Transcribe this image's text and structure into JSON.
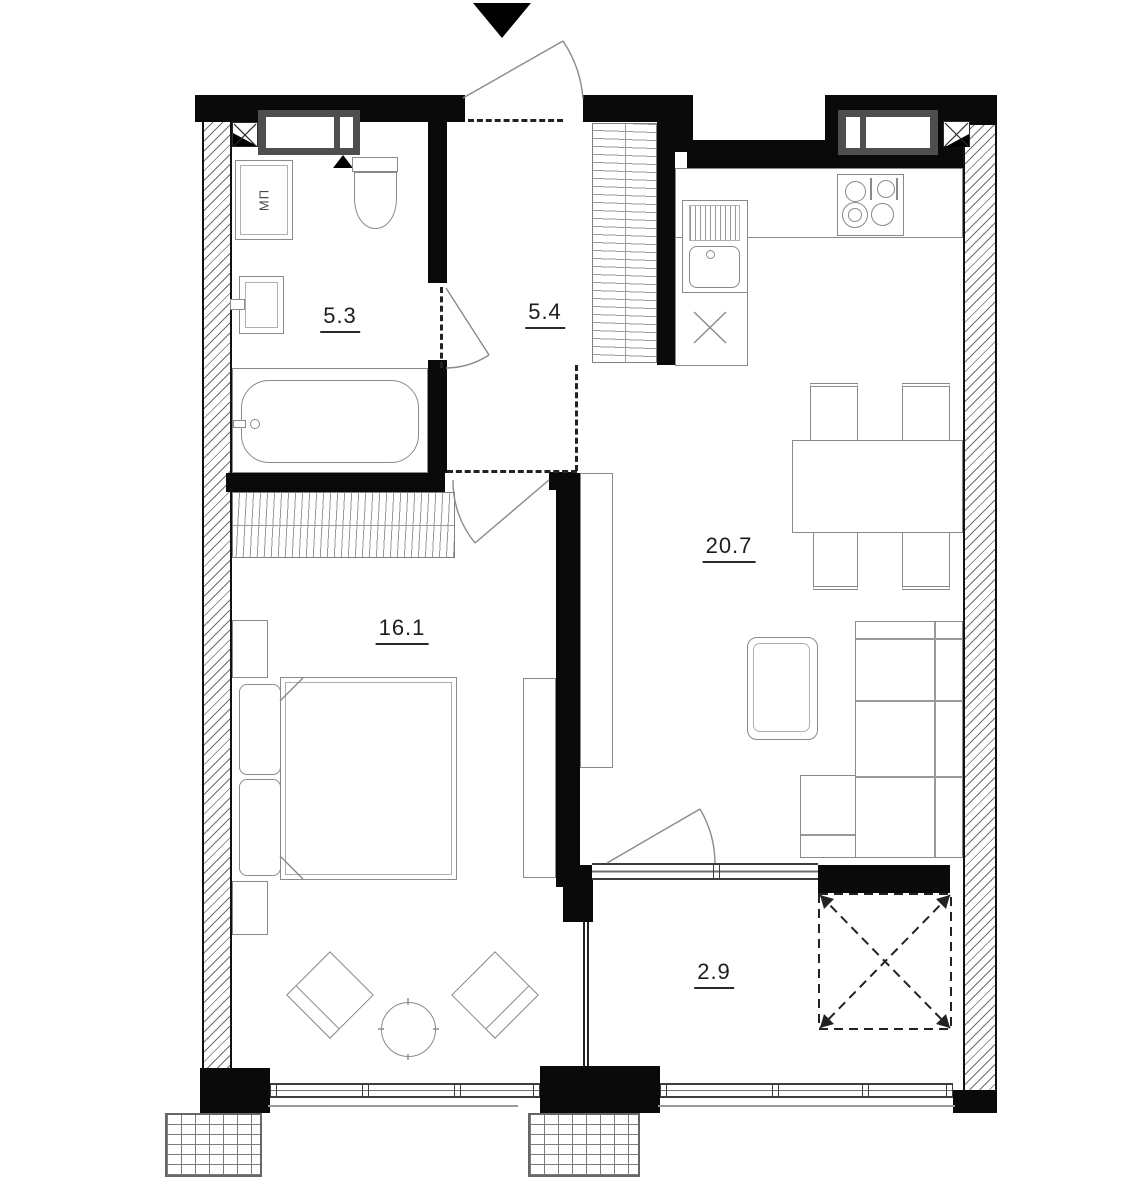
{
  "plan": {
    "rooms": [
      {
        "name": "bathroom",
        "area": "5.3"
      },
      {
        "name": "hallway",
        "area": "5.4"
      },
      {
        "name": "bedroom",
        "area": "16.1"
      },
      {
        "name": "living-kitchen",
        "area": "20.7"
      },
      {
        "name": "balcony",
        "area": "2.9"
      }
    ],
    "labels": {
      "washer": "МП"
    },
    "colors": {
      "wall": "#0a0a0a",
      "furniture_line": "#8a8a8a",
      "hatch": "#6e6e6e",
      "window_frame": "#4e4e4e",
      "text": "#1d1d1d"
    }
  }
}
